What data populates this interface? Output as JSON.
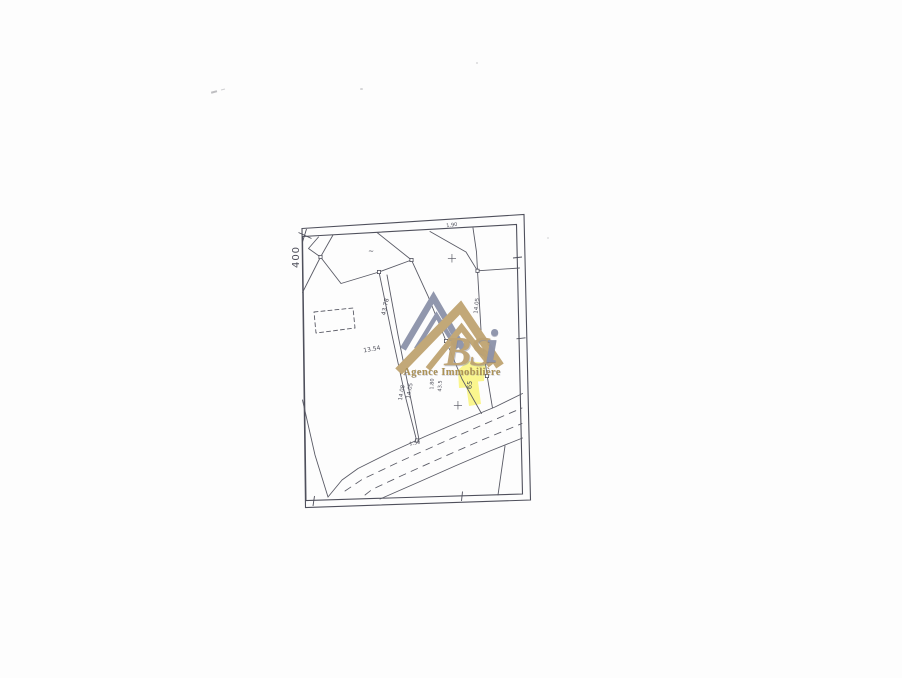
{
  "document": {
    "type": "scanned cadastral plan",
    "background": "#fdfdfd"
  },
  "watermark": {
    "brand_bs": "BS",
    "brand_i": "i",
    "subtitle": "Agence Immobilière"
  },
  "colors": {
    "line": "#5a5b66",
    "logo_gray": "#9197ad",
    "logo_tan": "#c2a878",
    "subtitle_gold": "#a98e4f",
    "highlight": "#f8f36e"
  },
  "map": {
    "labels": [
      {
        "text": "400"
      },
      {
        "text": "1.90"
      },
      {
        "text": "~"
      },
      {
        "text": "+"
      },
      {
        "text": "13.54"
      },
      {
        "text": "43.78"
      },
      {
        "text": "14.05"
      },
      {
        "text": "14.08"
      },
      {
        "text": "14.05"
      },
      {
        "text": "1.80"
      },
      {
        "text": "43.5"
      },
      {
        "text": "65"
      },
      {
        "text": "1.50"
      },
      {
        "text": "+"
      }
    ]
  }
}
